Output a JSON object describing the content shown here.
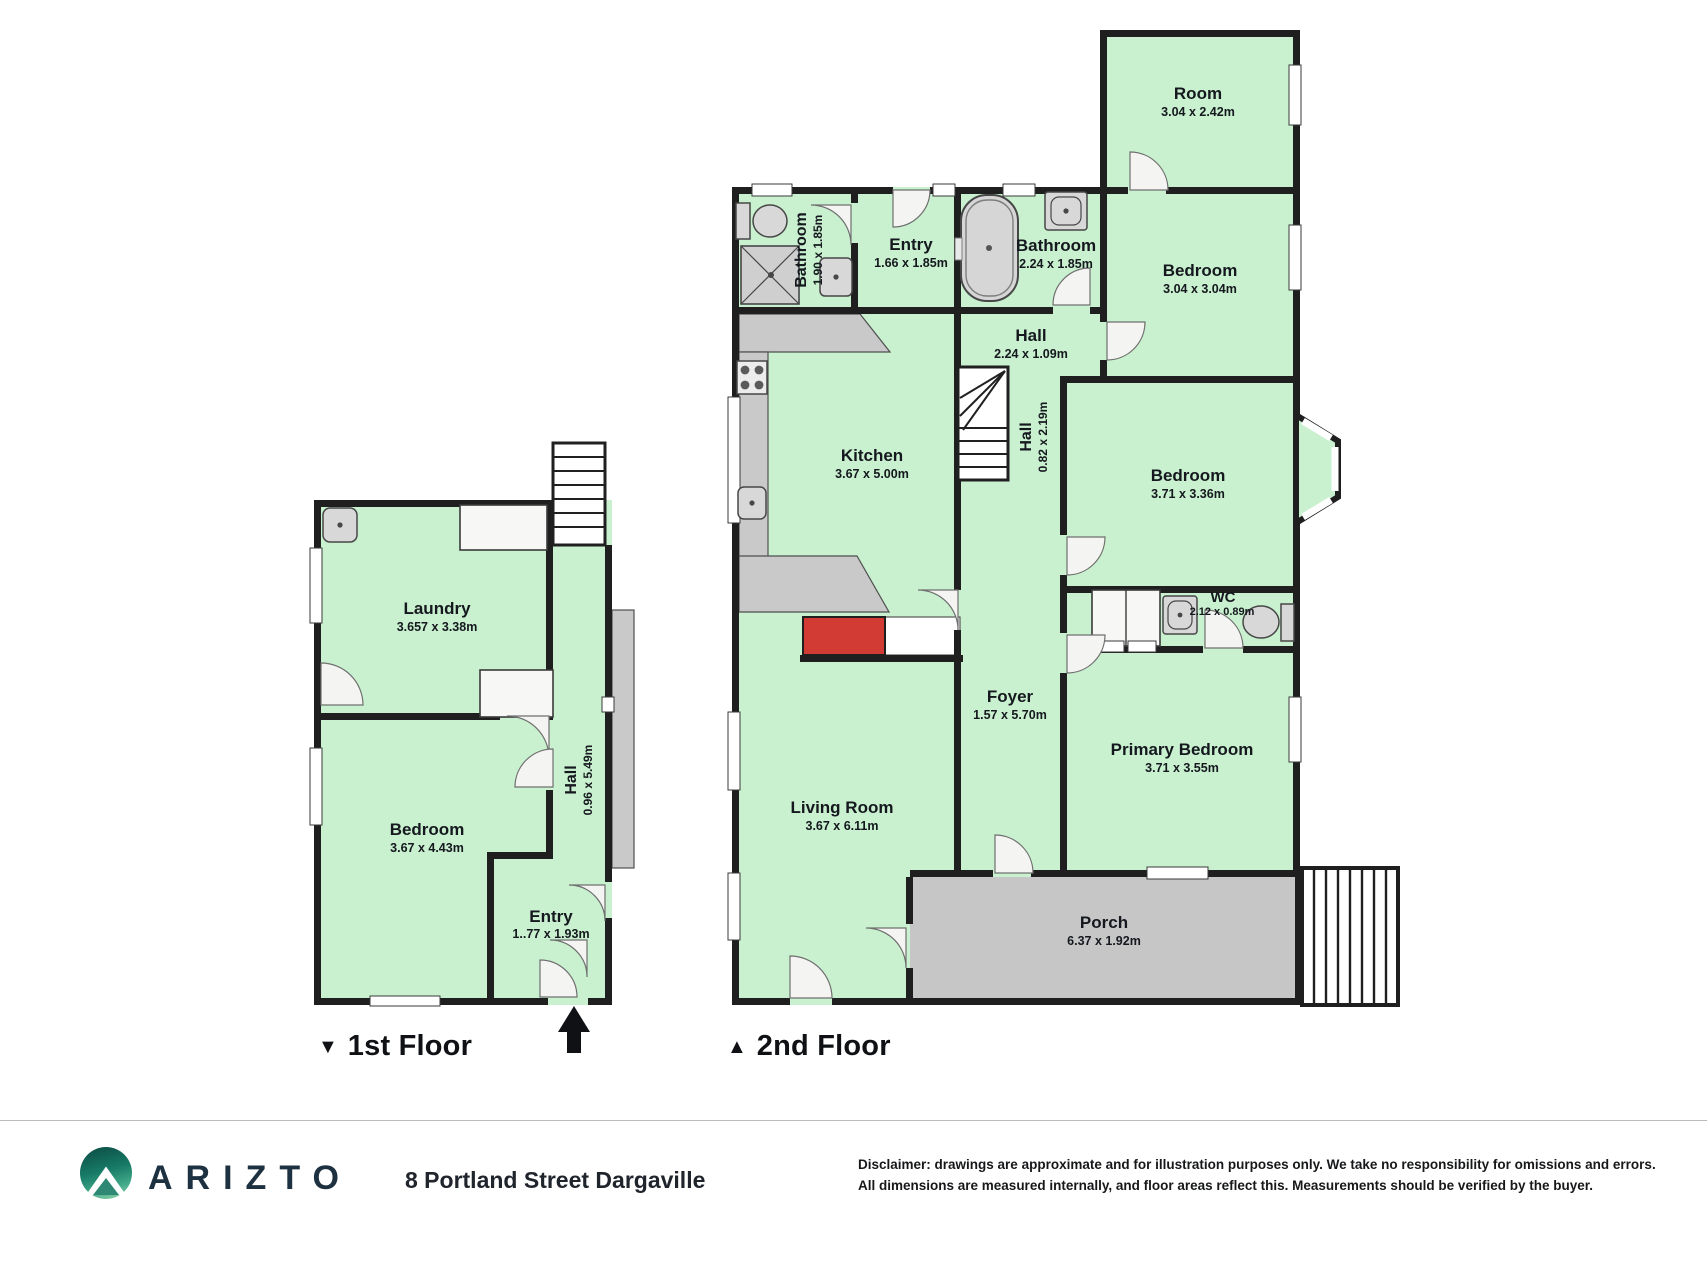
{
  "colors": {
    "room_fill": "#c9f1cf",
    "wall": "#1f1f1f",
    "hard_surface": "#c9c9c9",
    "highlight_red": "#d23b34",
    "brand_dark": "#1d3140",
    "brand_teal": "#177a66"
  },
  "floors": [
    {
      "marker": "▼",
      "label": "1st Floor",
      "rooms": [
        {
          "name": "Laundry",
          "dims": "3.657 x 3.38m"
        },
        {
          "name": "Bedroom",
          "dims": "3.67 x 4.43m"
        },
        {
          "name": "Hall",
          "dims": "0.96 x 5.49m"
        },
        {
          "name": "Entry",
          "dims": "1..77 x 1.93m"
        }
      ]
    },
    {
      "marker": "▲",
      "label": "2nd Floor",
      "rooms": [
        {
          "name": "Room",
          "dims": "3.04 x 2.42m"
        },
        {
          "name": "Bathroom",
          "dims": "1.90 x 1.85m"
        },
        {
          "name": "Entry",
          "dims": "1.66 x 1.85m"
        },
        {
          "name": "Bathroom",
          "dims": "2.24 x 1.85m"
        },
        {
          "name": "Bedroom",
          "dims": "3.04 x 3.04m"
        },
        {
          "name": "Hall",
          "dims": "2.24 x 1.09m"
        },
        {
          "name": "Kitchen",
          "dims": "3.67 x 5.00m"
        },
        {
          "name": "Hall",
          "dims": "0.82 x 2.19m"
        },
        {
          "name": "Bedroom",
          "dims": "3.71 x 3.36m"
        },
        {
          "name": "WC",
          "dims": "2.12 x 0.89m"
        },
        {
          "name": "Foyer",
          "dims": "1.57 x 5.70m"
        },
        {
          "name": "Primary Bedroom",
          "dims": "3.71 x 3.55m"
        },
        {
          "name": "Living Room",
          "dims": "3.67 x 6.11m"
        },
        {
          "name": "Porch",
          "dims": "6.37 x 1.92m"
        }
      ]
    }
  ],
  "footer": {
    "brand": "ARIZTO",
    "address": "8 Portland Street Dargaville",
    "disclaimer_line1": "Disclaimer: drawings are approximate and for illustration purposes only. We take no responsibility for omissions and errors.",
    "disclaimer_line2": "All dimensions are measured internally, and floor areas reflect this. Measurements should be verified by the buyer."
  }
}
